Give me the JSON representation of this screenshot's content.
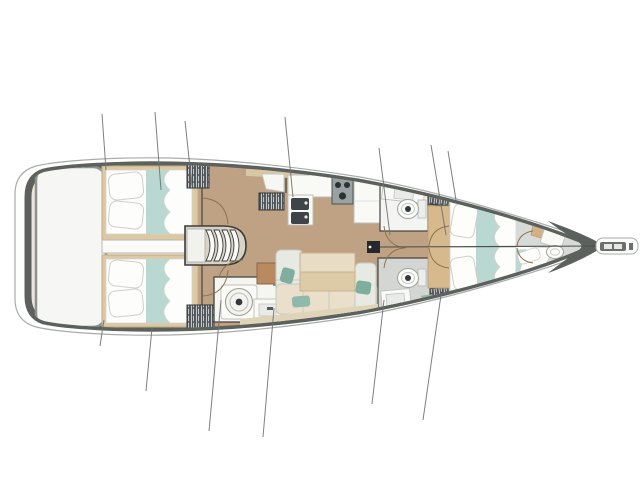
{
  "meta": {
    "description": "Top-down interior deck plan of a sailing monohull yacht, bow pointing right, no text labels rendered in the image",
    "orientation": "bow-right",
    "top_side": "port"
  },
  "colors": {
    "page_bg": "#ffffff",
    "topsides": "#ffffff",
    "hull_outline": "#a8aca9",
    "deck_band": "#5d615e",
    "interior_base": "#ece6d8",
    "platform": "#f6f6f4",
    "platform_border": "#8f938f",
    "sole": "#bfa183",
    "wood_shelf": "#d9c7a4",
    "bed_platform": "#dcc9a3",
    "bed_platform_edge": "#c3ab84",
    "bedding_white": "#fdfdfc",
    "bedding_stroke": "#d4d4ce",
    "bedding_teal": "#b9d8d1",
    "pillow_stroke": "#cfcfca",
    "locker": "#4d5357",
    "locker_hatch": "#d9dcdd",
    "locker_edge": "#33393c",
    "counter": "#f9f9f6",
    "counter_stroke": "#bfbfba",
    "stove": "#99a1a3",
    "burner": "#2c3234",
    "sink_dark": "#3d4549",
    "head_wall": "#f4f5f2",
    "head_floor": "#d3d6d3",
    "fixture_white": "#fbfbf8",
    "fixture_stroke": "#9fa39f",
    "drain": "#34393c",
    "sofa": "#e7eae3",
    "sofa_stroke": "#c5c9c0",
    "bench_cream": "#e9dfca",
    "table_light": "#e8dcc4",
    "table_dark": "#ddcaa7",
    "table_stroke": "#c7b28d",
    "pillow_teal": "#7fae9e",
    "pillow_teal2": "#8fb9ab",
    "cabinet_brown": "#b78a60",
    "cabinet_brown_edge": "#8a6647",
    "wall_line": "#45453f",
    "door_arc": "#8a7450",
    "rig_line": "#6f736f",
    "forestay": "#4c4f4c",
    "mast": "#26292b",
    "steps_base": "#d8d3c6",
    "steps_edge": "#3c3c38",
    "landing": "#f1f1ee",
    "bow_floor": "#d7dad6",
    "bow_wood": "#d2b187",
    "entry_wood": "#d6ba8e",
    "bowsprit_fitting": "#6b6f6d",
    "shelf_cream": "#e0d4b8"
  },
  "plan": {
    "regions": [
      {
        "name": "swim-platform",
        "features": [
          "transom-platform"
        ]
      },
      {
        "name": "aft-cabin-port",
        "features": [
          "double-bed",
          "pillows",
          "teal-runner",
          "duvet",
          "wardrobe"
        ]
      },
      {
        "name": "aft-cabin-starboard",
        "features": [
          "double-bed",
          "pillows",
          "teal-runner",
          "duvet",
          "wardrobe"
        ]
      },
      {
        "name": "engine-compartment",
        "features": []
      },
      {
        "name": "companionway-steps",
        "features": [
          "four-treads",
          "landing"
        ]
      },
      {
        "name": "galley",
        "features": [
          "corner-locker",
          "double-sink",
          "three-burner-stove",
          "counter",
          "fridge",
          "wood-shelf"
        ]
      },
      {
        "name": "head-forward-port",
        "features": [
          "toilet",
          "sink",
          "wardrobe"
        ]
      },
      {
        "name": "head-forward-starboard",
        "features": [
          "toilet",
          "sink",
          "shower",
          "towel"
        ]
      },
      {
        "name": "head-aft-starboard",
        "features": [
          "toilet-front-load-style",
          "sink",
          "vent"
        ]
      },
      {
        "name": "saloon-dinette",
        "features": [
          "u-shaped-sofa",
          "table",
          "teal-cushions",
          "chart-cabinet",
          "side-shelf"
        ]
      },
      {
        "name": "forward-cabin",
        "features": [
          "twin-beds",
          "pillows",
          "teal-runners",
          "duvets",
          "two-wardrobes",
          "double-entry-doors",
          "wood-entry"
        ]
      },
      {
        "name": "bow-cabin",
        "features": [
          "berth",
          "pillow",
          "sink",
          "counter",
          "wood-locker"
        ]
      },
      {
        "name": "bowsprit",
        "features": [
          "anchor-roller"
        ]
      },
      {
        "name": "mast-step",
        "features": [
          "forestay-line"
        ]
      },
      {
        "name": "rigging-section-lines",
        "count_top": 7,
        "count_bottom": 6
      }
    ]
  }
}
